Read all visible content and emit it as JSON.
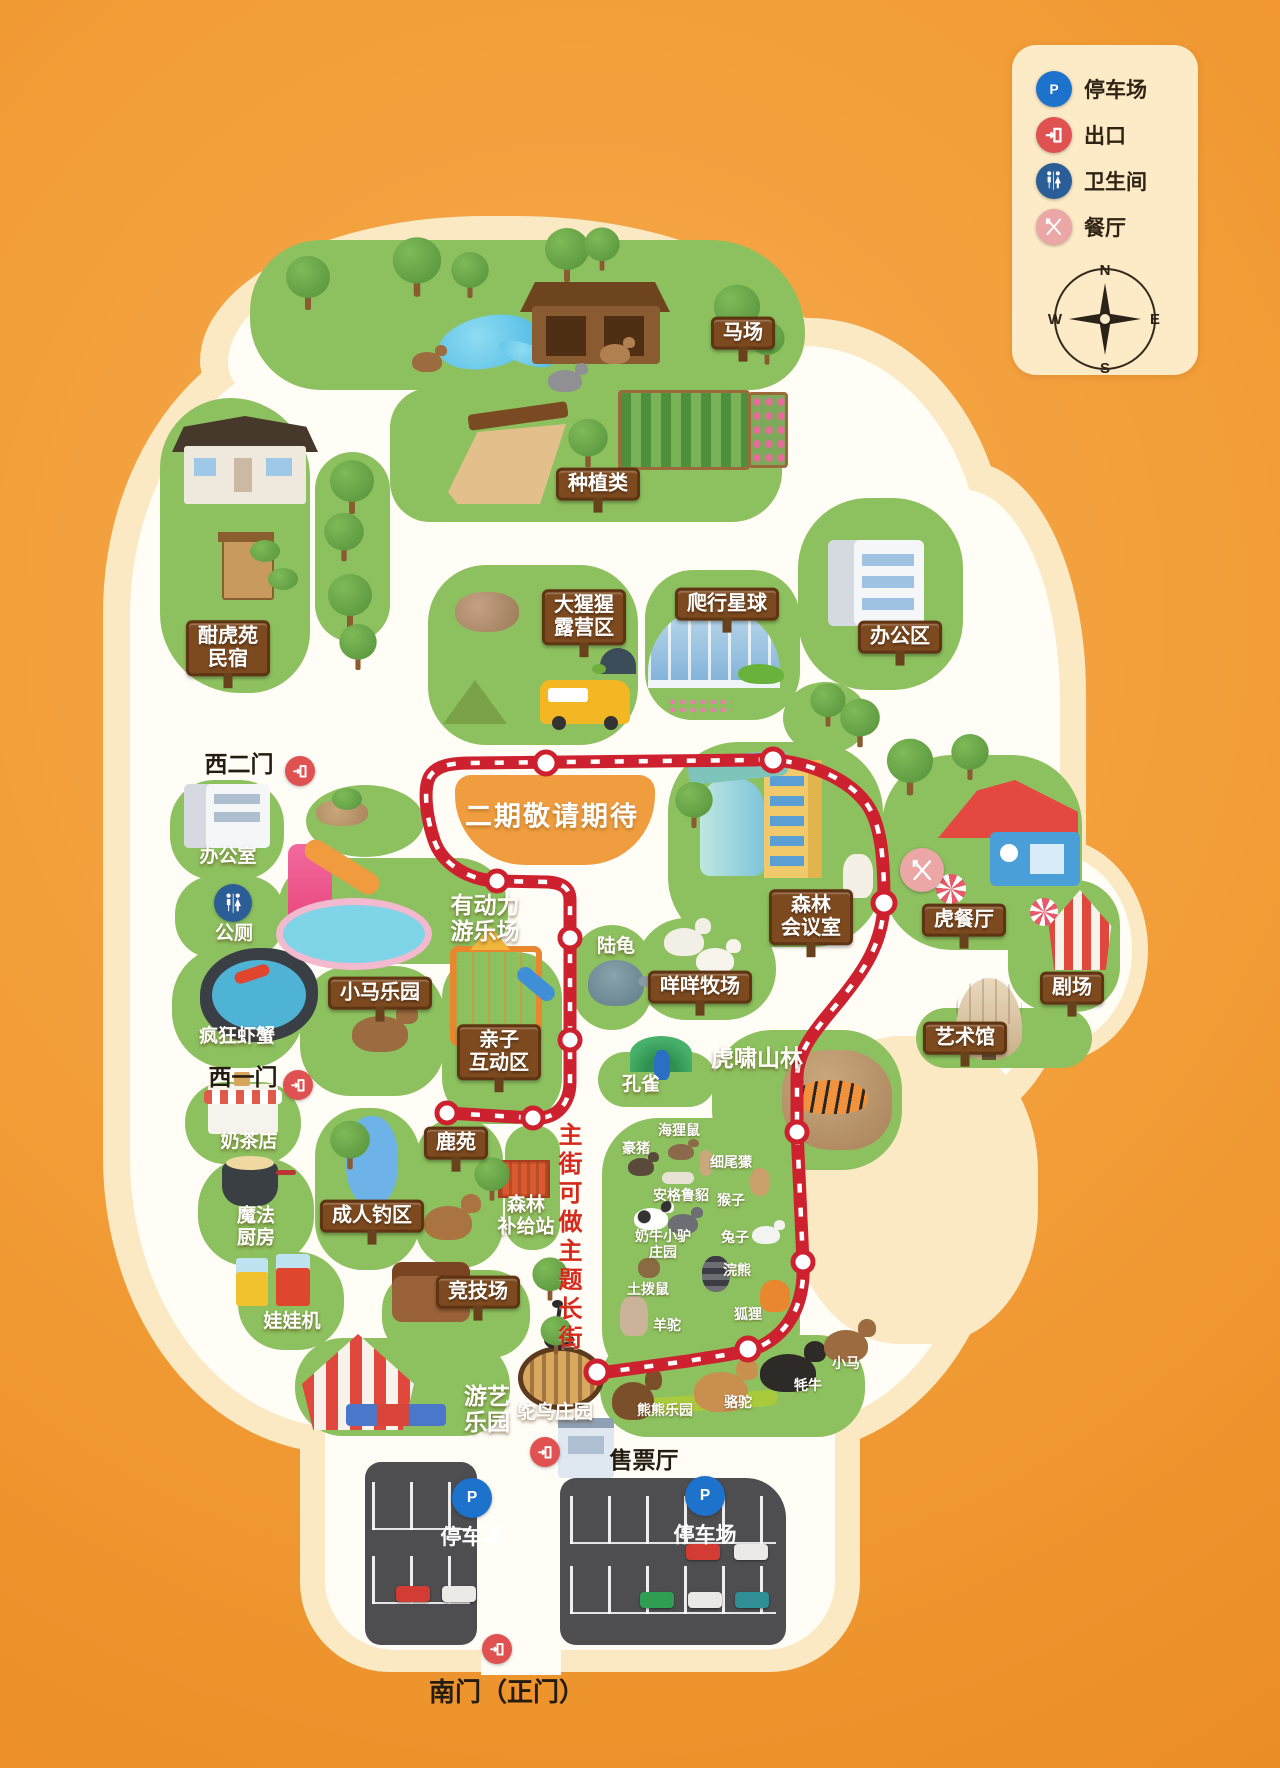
{
  "palette": {
    "background_orange": "#f29d38",
    "island_cream": "#fbe9c4",
    "road_white": "#fffdf6",
    "area_green": "#8dc05e",
    "route_red": "#ce2130",
    "sign_brown": "#7d4a1f",
    "parking_gray": "#4e4d4f",
    "phase2_orange": "#ef9d3f",
    "legend_panel": "#fdeac6"
  },
  "legend": {
    "items": [
      {
        "type": "parking",
        "name": "legend-parking",
        "label": "停车场"
      },
      {
        "type": "exit",
        "name": "legend-exit",
        "label": "出口"
      },
      {
        "type": "toilet",
        "name": "legend-toilet",
        "label": "卫生间"
      },
      {
        "type": "restaurant",
        "name": "legend-restaurant",
        "label": "餐厅"
      }
    ],
    "compass": {
      "north": "N",
      "east": "E",
      "south": "S",
      "west": "W"
    }
  },
  "map": {
    "labels": [
      {
        "name": "horse-ranch-sign",
        "text": "马场",
        "x": 743,
        "y": 333,
        "type": "sign"
      },
      {
        "name": "planting-sign",
        "text": "种植类",
        "x": 598,
        "y": 484,
        "type": "sign"
      },
      {
        "name": "homestay-sign",
        "text": "酣虎苑\n民宿",
        "x": 228,
        "y": 648,
        "type": "sign"
      },
      {
        "name": "gorilla-camp-sign",
        "text": "大猩猩\n露营区",
        "x": 584,
        "y": 617,
        "type": "sign"
      },
      {
        "name": "reptile-planet-sign",
        "text": "爬行星球",
        "x": 727,
        "y": 604,
        "type": "sign"
      },
      {
        "name": "office-area-sign",
        "text": "办公区",
        "x": 900,
        "y": 637,
        "type": "sign"
      },
      {
        "name": "west-gate-2-label",
        "text": "西二门",
        "x": 239,
        "y": 764,
        "type": "black"
      },
      {
        "name": "office-room-label",
        "text": "办公室",
        "x": 228,
        "y": 857,
        "type": "white"
      },
      {
        "name": "public-toilet-label",
        "text": "公厕",
        "x": 234,
        "y": 934,
        "type": "white"
      },
      {
        "name": "crazy-shrimp-label",
        "text": "疯狂虾蟹",
        "x": 237,
        "y": 1037,
        "type": "white"
      },
      {
        "name": "west-gate-1-label",
        "text": "西一门",
        "x": 243,
        "y": 1077,
        "type": "black"
      },
      {
        "name": "milk-tea-label",
        "text": "奶茶店",
        "x": 249,
        "y": 1142,
        "type": "white"
      },
      {
        "name": "magic-kitchen-label",
        "text": "魔法\n厨房",
        "x": 256,
        "y": 1227,
        "type": "white"
      },
      {
        "name": "claw-machine-label",
        "text": "娃娃机",
        "x": 292,
        "y": 1322,
        "type": "white"
      },
      {
        "name": "phase2-label",
        "text": "二期敬请期待",
        "x": 552,
        "y": 817,
        "type": "whitexl"
      },
      {
        "name": "powered-playground-label",
        "text": "有动力\n游乐场",
        "x": 485,
        "y": 918,
        "type": "whitelg"
      },
      {
        "name": "pony-park-sign",
        "text": "小马乐园",
        "x": 380,
        "y": 993,
        "type": "sign"
      },
      {
        "name": "parent-child-sign",
        "text": "亲子\n互动区",
        "x": 499,
        "y": 1052,
        "type": "sign"
      },
      {
        "name": "tortoise-label",
        "text": "陆龟",
        "x": 616,
        "y": 947,
        "type": "white"
      },
      {
        "name": "sheep-ranch-sign",
        "text": "咩咩牧场",
        "x": 700,
        "y": 987,
        "type": "sign"
      },
      {
        "name": "forest-meeting-sign",
        "text": "森林\n会议室",
        "x": 811,
        "y": 917,
        "type": "sign"
      },
      {
        "name": "tiger-restaurant-sign",
        "text": "虎餐厅",
        "x": 964,
        "y": 920,
        "type": "sign"
      },
      {
        "name": "theater-sign",
        "text": "剧场",
        "x": 1072,
        "y": 988,
        "type": "sign"
      },
      {
        "name": "art-museum-sign",
        "text": "艺术馆",
        "x": 965,
        "y": 1038,
        "type": "sign"
      },
      {
        "name": "tiger-forest-label",
        "text": "虎啸山林",
        "x": 757,
        "y": 1058,
        "type": "whitelg"
      },
      {
        "name": "peacock-label",
        "text": "孔雀",
        "x": 641,
        "y": 1085,
        "type": "white"
      },
      {
        "name": "adult-fishing-sign",
        "text": "成人钓区",
        "x": 372,
        "y": 1216,
        "type": "sign"
      },
      {
        "name": "deer-garden-sign",
        "text": "鹿苑",
        "x": 456,
        "y": 1143,
        "type": "sign"
      },
      {
        "name": "forest-supply-label",
        "text": "森林\n补给站",
        "x": 526,
        "y": 1216,
        "type": "white"
      },
      {
        "name": "arena-sign",
        "text": "竞技场",
        "x": 478,
        "y": 1292,
        "type": "sign"
      },
      {
        "name": "amusement-park-label",
        "text": "游艺\n乐园",
        "x": 487,
        "y": 1409,
        "type": "whitelg"
      },
      {
        "name": "main-street-label",
        "text": "主街可做主题长街",
        "x": 567,
        "y": 1238,
        "type": "redv"
      },
      {
        "name": "ostrich-manor-label",
        "text": "鸵鸟庄园",
        "x": 555,
        "y": 1413,
        "type": "white"
      },
      {
        "name": "bear-park-label",
        "text": "熊熊乐园",
        "x": 665,
        "y": 1411,
        "type": "whitesm"
      },
      {
        "name": "camel-label",
        "text": "骆驼",
        "x": 738,
        "y": 1403,
        "type": "whitesm"
      },
      {
        "name": "yak-label",
        "text": "牦牛",
        "x": 808,
        "y": 1386,
        "type": "whitesm"
      },
      {
        "name": "pony-label",
        "text": "小马",
        "x": 846,
        "y": 1364,
        "type": "whitesm"
      },
      {
        "name": "nutria-label",
        "text": "海狸鼠",
        "x": 679,
        "y": 1131,
        "type": "whitesm"
      },
      {
        "name": "porcupine-label",
        "text": "豪猪",
        "x": 636,
        "y": 1149,
        "type": "whitesm"
      },
      {
        "name": "meerkat-label",
        "text": "细尾獴",
        "x": 731,
        "y": 1163,
        "type": "whitesm"
      },
      {
        "name": "ferret-label",
        "text": "安格鲁貂",
        "x": 681,
        "y": 1196,
        "type": "whitesm"
      },
      {
        "name": "monkey-label",
        "text": "猴子",
        "x": 731,
        "y": 1201,
        "type": "whitesm"
      },
      {
        "name": "cow-donkey-label",
        "text": "奶牛小驴\n庄园",
        "x": 663,
        "y": 1245,
        "type": "whitesm"
      },
      {
        "name": "rabbit-label",
        "text": "兔子",
        "x": 735,
        "y": 1238,
        "type": "whitesm"
      },
      {
        "name": "groundhog-label",
        "text": "土拨鼠",
        "x": 648,
        "y": 1290,
        "type": "whitesm"
      },
      {
        "name": "raccoon-label",
        "text": "浣熊",
        "x": 737,
        "y": 1271,
        "type": "whitesm"
      },
      {
        "name": "fox-label",
        "text": "狐狸",
        "x": 748,
        "y": 1315,
        "type": "whitesm"
      },
      {
        "name": "alpaca-label",
        "text": "羊驼",
        "x": 667,
        "y": 1326,
        "type": "whitesm"
      },
      {
        "name": "ticket-hall-label",
        "text": "售票厅",
        "x": 644,
        "y": 1460,
        "type": "black"
      },
      {
        "name": "parking-left-label",
        "text": "停车场",
        "x": 472,
        "y": 1538,
        "type": "whitelot"
      },
      {
        "name": "parking-right-label",
        "text": "停车场",
        "x": 705,
        "y": 1536,
        "type": "whitelot"
      },
      {
        "name": "south-gate-label",
        "text": "南门（正门）",
        "x": 507,
        "y": 1693,
        "type": "blacklg"
      }
    ],
    "icons": [
      {
        "name": "west-gate-2-exit-icon",
        "type": "exit",
        "x": 300,
        "y": 771,
        "s": 30
      },
      {
        "name": "west-gate-1-exit-icon",
        "type": "exit",
        "x": 298,
        "y": 1085,
        "s": 30
      },
      {
        "name": "ticket-exit-icon",
        "type": "exit",
        "x": 545,
        "y": 1452,
        "s": 30
      },
      {
        "name": "south-gate-exit-icon",
        "type": "exit",
        "x": 497,
        "y": 1649,
        "s": 30
      },
      {
        "name": "public-toilet-icon",
        "type": "toilet",
        "x": 233,
        "y": 903,
        "s": 38
      },
      {
        "name": "tiger-restaurant-icon",
        "type": "restaurant",
        "x": 922,
        "y": 870,
        "s": 44
      },
      {
        "name": "parking-left-p-icon",
        "type": "parking",
        "x": 472,
        "y": 1498,
        "s": 40
      },
      {
        "name": "parking-right-p-icon",
        "type": "parking",
        "x": 705,
        "y": 1496,
        "s": 40
      }
    ]
  }
}
